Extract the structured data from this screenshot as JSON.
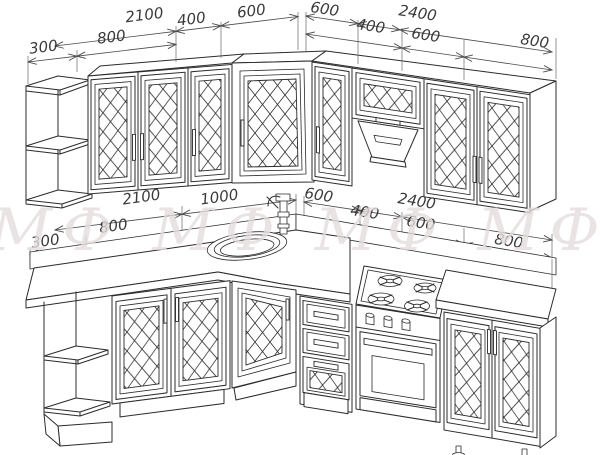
{
  "drawing": {
    "type": "kitchen-layout-wireframe",
    "watermark_text": "МФ  МФ  МФ  МФ",
    "colors": {
      "line": "#2b2b2b",
      "dimension": "#4a4a4a",
      "watermark": "#e4dedd",
      "background": "#ffffff"
    }
  },
  "dims": {
    "upper": {
      "total_left": "2100",
      "total_right": "2400",
      "left": {
        "s300": "300",
        "s800": "800",
        "s400": "400",
        "s600": "600"
      },
      "right": {
        "s600a": "600",
        "s400": "400",
        "s600b": "600",
        "s800": "800"
      }
    },
    "lower": {
      "total_left": "2100",
      "total_right": "2400",
      "left": {
        "s300": "300",
        "s800": "800",
        "s1000": "1000"
      },
      "right": {
        "s600a": "600",
        "s400": "400",
        "s600b": "600",
        "s800": "800"
      }
    }
  }
}
